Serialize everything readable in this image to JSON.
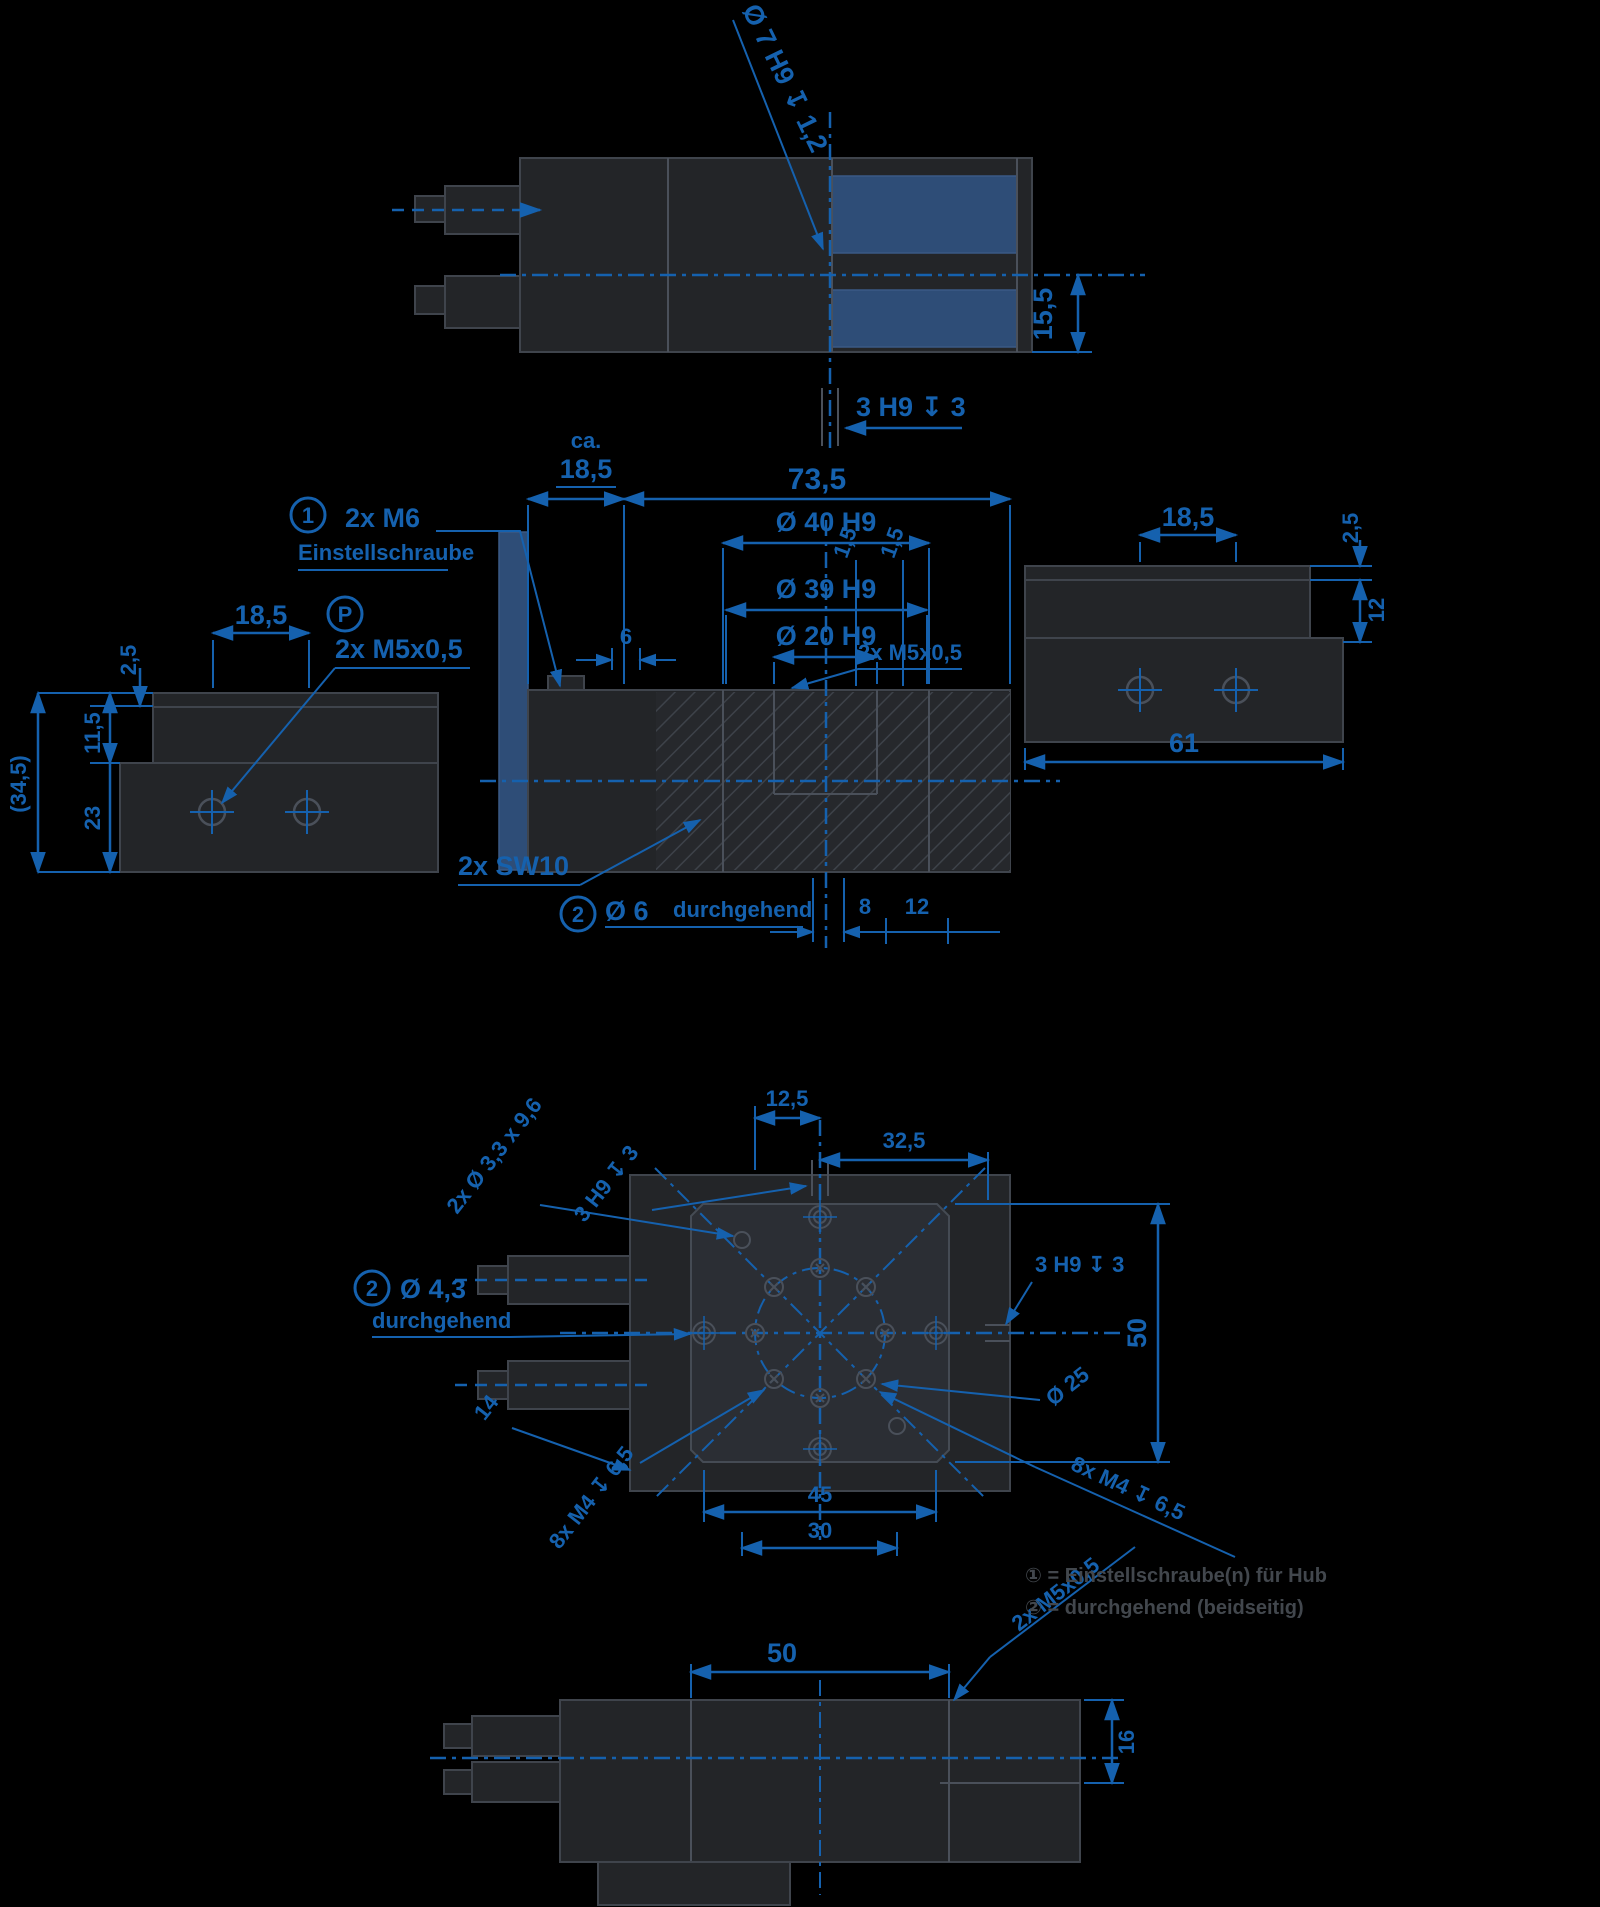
{
  "drawing": {
    "accent_color": "#1561ae",
    "highlight_color": "#2e4d77",
    "top_view": {
      "bore_callout": "Ø 7 H9 ↧ 1,2",
      "dim_height": "15,5",
      "slot_label": "3 H9 ↧ 3"
    },
    "front_view": {
      "dim_ca_prefix": "ca.",
      "dim_ca": "18,5",
      "dim_length": "73,5",
      "dim_d40": "Ø 40 H9",
      "dim_d39": "Ø 39 H9",
      "dim_d20": "Ø 20 H9",
      "dim_6": "6",
      "dim_15a": "1,5",
      "dim_15b": "1,5",
      "adjust_num": "1",
      "adjust_label": "2x M6",
      "adjust_sub": "Einstellschraube",
      "port_label": "2x M5x0,5",
      "wrench_label": "2x SW10",
      "through_num": "2",
      "through_label": "Ø 6",
      "through_sub": "durchgehend",
      "dim_8": "8",
      "dim_12": "12"
    },
    "left_view": {
      "dim_top": "18,5",
      "port_num": "P",
      "port_label": "2x M5x0,5",
      "dim_25": "2,5",
      "dim_115": "11,5",
      "dim_23": "23",
      "dim_total": "(34,5)"
    },
    "right_view": {
      "dim_top": "18,5",
      "dim_25": "2,5",
      "dim_12": "12",
      "dim_width": "61"
    },
    "pattern_view": {
      "dim_125": "12,5",
      "dim_325": "32,5",
      "holes_callout": "2x Ø 3,3 x 9,6",
      "slot_callout_left": "3 H9 ↧ 3",
      "slot_label_right": "3 H9 ↧ 3",
      "dim_50": "50",
      "bolt_circle": "Ø 25",
      "through_num": "2",
      "through_label": "Ø 4,3",
      "through_sub": "durchgehend",
      "dim_14": "14",
      "dim_45": "45",
      "dim_30": "30",
      "m4_left": "8x M4 ↧ 6,5",
      "m4_right": "8x M4 ↧ 6,5"
    },
    "bottom_view": {
      "dim_50": "50",
      "port_label": "2x M5x0,5",
      "dim_16": "16"
    },
    "legend": {
      "line1": "① = Einstellschraube(n) für Hub",
      "line2": "② = durchgehend (beidseitig)"
    }
  }
}
